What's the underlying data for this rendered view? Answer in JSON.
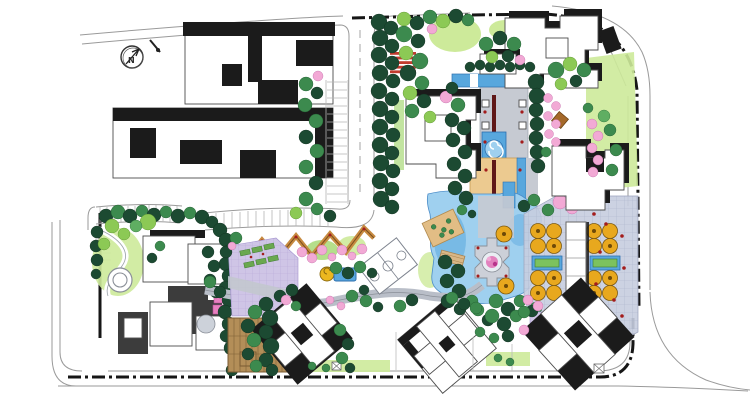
{
  "page": {
    "kind": "landscape-architecture-master-plan",
    "north_arrow": {
      "label": "N"
    }
  },
  "palette": {
    "background": "#ffffff",
    "road_line": "#9a9a9a",
    "building_outline": "#4d4d4d",
    "shadow_black": "#1b1b1b",
    "shadow_gray": "#3c3c3c",
    "tree_dark": "#1c4a32",
    "tree_green": "#3c8a4e",
    "tree_medium": "#5fae62",
    "tree_light": "#8cc955",
    "tree_pink": "#f2a9d5",
    "tree_orange": "#e8a81e",
    "orange_dark": "#7d5a10",
    "lawn_lime": "#cdea9a",
    "lawn_green": "#a8d977",
    "water_light": "#9fd0ef",
    "water_mid": "#58a7dd",
    "water_deep": "#2e6fae",
    "plaza_tan": "#ecca90",
    "plaza_gray": "#c6cad2",
    "plaza_lavender": "#cfc5e6",
    "paving_blue_gray": "#c7cddf",
    "deck_wood": "#b38e58",
    "deck_wood_dark": "#7d5f35",
    "pergola_orange": "#c78a40",
    "court_line": "#7d838e",
    "red_accent": "#a31c1c",
    "crosswalk_red": "#c23b2e",
    "axis_line_maroon": "#5f1717"
  },
  "features": {
    "context": "existing-buildings",
    "water": "central-pond-and-water-axis",
    "sport": "basketball-court",
    "structures": [
      "pergola-zigzag",
      "entry-canopy",
      "wood-deck",
      "pond-platform"
    ],
    "circulation": [
      "perimeter-road",
      "internal-road",
      "parking-stalls",
      "crosswalk"
    ]
  }
}
